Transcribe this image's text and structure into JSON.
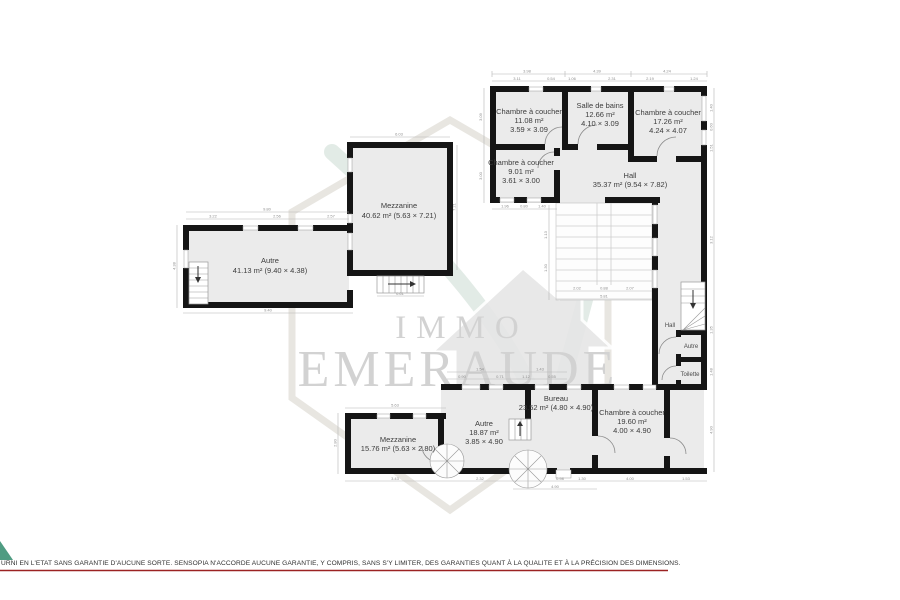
{
  "watermark": {
    "brand_top": "IMMO",
    "brand_bottom": "EMERAUDE"
  },
  "rooms": {
    "chambre_nw": {
      "l1": "Chambre à coucher",
      "l2": "11.08 m²",
      "l3": "3.59 × 3.09"
    },
    "salle_de_bains": {
      "l1": "Salle de bains",
      "l2": "12.66 m²",
      "l3": "4.10 × 3.09"
    },
    "chambre_ne": {
      "l1": "Chambre à coucher",
      "l2": "17.26 m²",
      "l3": "4.24 × 4.07"
    },
    "chambre_w": {
      "l1": "Chambre à coucher",
      "l2": "9.01 m²",
      "l3": "3.61 × 3.00"
    },
    "hall_main": {
      "l1": "Hall",
      "l2": "35.37 m² (9.54 × 7.82)"
    },
    "mezzanine_upper": {
      "l1": "Mezzanine",
      "l2": "40.62 m² (5.63 × 7.21)"
    },
    "autre_large": {
      "l1": "Autre",
      "l2": "41.13 m² (9.40 × 4.38)"
    },
    "hall_small": {
      "l1": "Hall"
    },
    "autre_small": {
      "l1": "Autre"
    },
    "toilette": {
      "l1": "Toilette"
    },
    "mezzanine_lower": {
      "l1": "Mezzanine",
      "l2": "15.76 m² (5.63 × 2.80)"
    },
    "autre_bottom": {
      "l1": "Autre",
      "l2": "18.87 m²",
      "l3": "3.85 × 4.90"
    },
    "bureau": {
      "l1": "Bureau",
      "l2": "23.52 m² (4.80 × 4.90)"
    },
    "chambre_s": {
      "l1": "Chambre à coucher",
      "l2": "19.60 m²",
      "l3": "4.00 × 4.90"
    }
  },
  "dims": {
    "t1": "3.98",
    "t2": "4.39",
    "t3": "4.24",
    "m1": "3.11",
    "m2": "0.54",
    "m3": "1.06",
    "m4": "2.31",
    "m5": "2.19",
    "m6": "1.24",
    "l1": "3.09",
    "l2": "3.00",
    "u1": "1.96",
    "u2": "0.80",
    "u3": "1.40",
    "sv1": "1.13",
    "sv2": "1.30",
    "sw1": "2.02",
    "sw2": "0.88",
    "sw3": "2.07",
    "sw4": "5.81",
    "mz1": "6.03",
    "mz2": "7.21",
    "mz3": "0.61",
    "a1": "3.22",
    "a2": "2.56",
    "a3": "2.57",
    "a4": "9.40",
    "a5": "4.38",
    "a6": "9.80",
    "r1": "1.40",
    "r2": "0.60",
    "r3": "1.51",
    "r4": "3.12",
    "r5": "1.35",
    "r6": "1.48",
    "r7": "4.90",
    "bt1": "1.54",
    "bt2": "1.43",
    "bt3": "0.90",
    "bt4": "0.71",
    "bt5": "1.12",
    "bt6": "0.55",
    "bb1": "3.43",
    "bb2": "2.32",
    "bb3": "0.98",
    "bb4": "1.30",
    "bb5": "4.00",
    "bb6": "1.53",
    "bb7": "4.90",
    "ml1": "5.63",
    "ml2": "2.80"
  },
  "footer": {
    "disclaimer": "URNI EN L'ETAT SANS GARANTIE D'AUCUNE SORTE. SENSOPIA N'ACCORDE AUCUNE GARANTIE, Y COMPRIS, SANS S'Y LIMITER, DES GARANTIES QUANT À LA QUALITE ET À LA PRÉCISION DES DIMENSIONS."
  },
  "colors": {
    "wall": "#151515",
    "room_fill": "#ebebeb",
    "accent_green": "#4f9c82",
    "footer_line": "#9b2222"
  }
}
